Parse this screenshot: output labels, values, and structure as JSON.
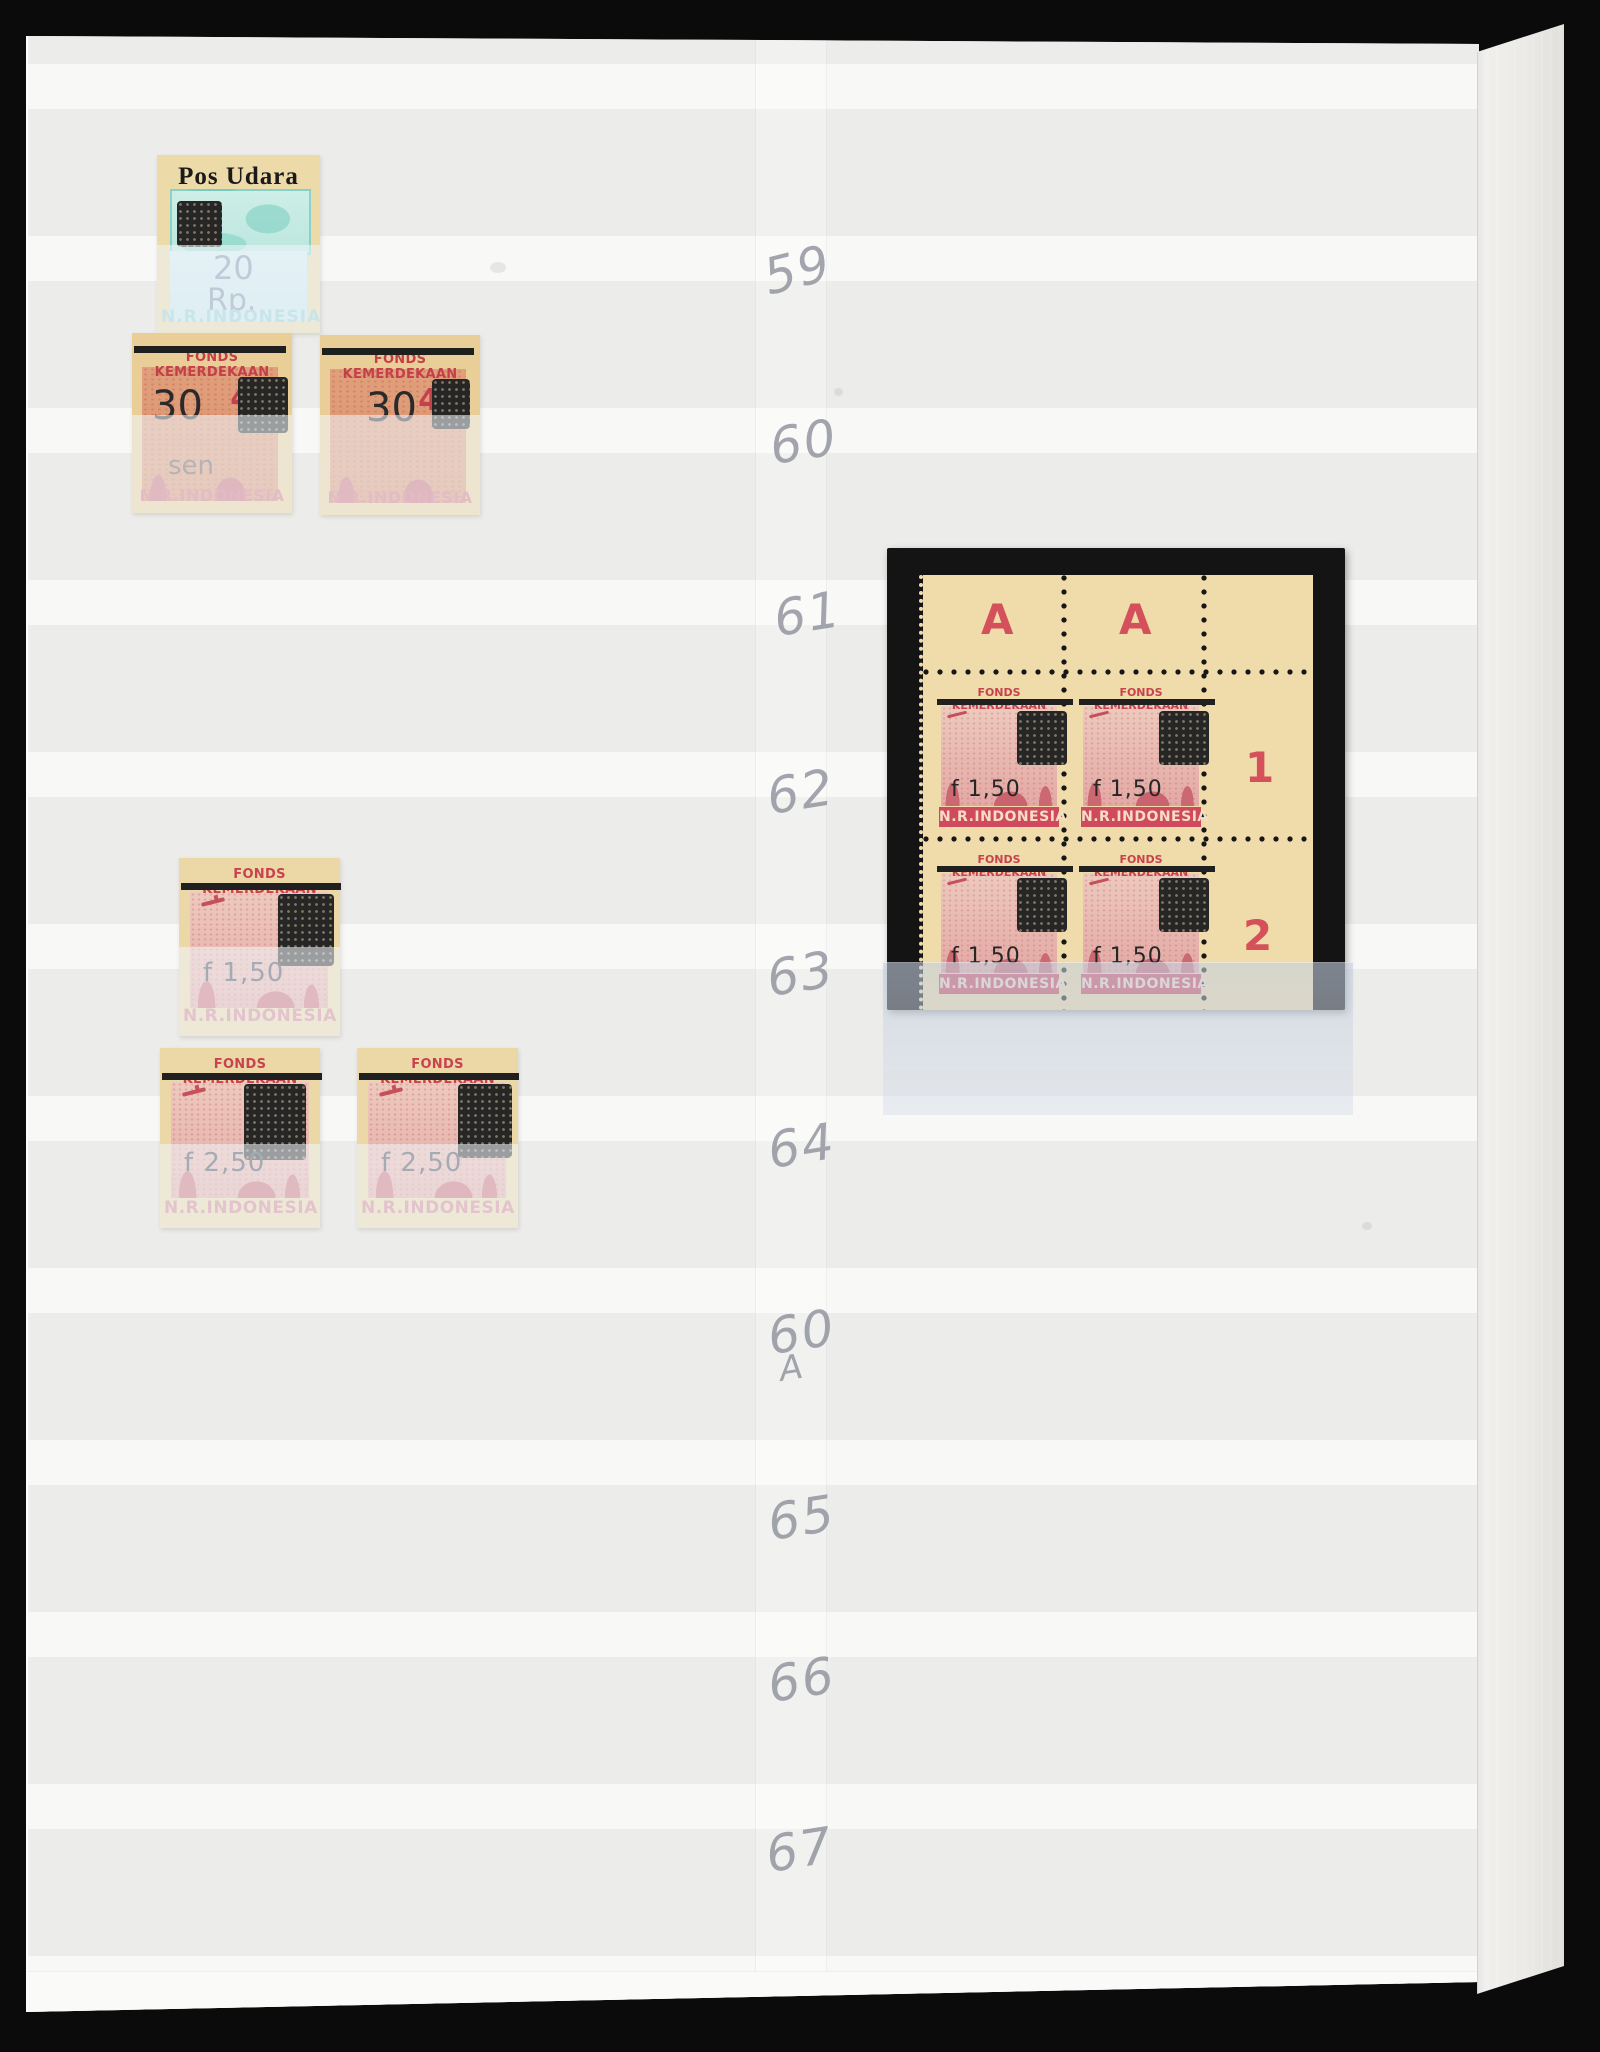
{
  "scene": {
    "description": "Stockbook album page with Indonesian revolutionary-period overprinted stamps and a corner block of four mounted on a black card",
    "colors": {
      "photo_background": "#0b0b0b",
      "page_band_light": "#f8f8f7",
      "page_band_dark": "#ececea",
      "stamp_paper_cream": "#eed9a4",
      "stamp_red": "#cf4a5c",
      "overprint_black": "#202020",
      "plate_marking_red": "#d4505a",
      "pencil_gray": "#9496a0",
      "glassine_blue": "#c5cfdf",
      "block_mount_black": "#141414"
    }
  },
  "pencil": {
    "n59": "59",
    "n60": "60",
    "n61": "61",
    "n62": "62",
    "n63": "63",
    "n64": "64",
    "n60a_main": "60",
    "n60a_suffix": "A",
    "n65": "65",
    "n66": "66",
    "n67": "67"
  },
  "stamps": {
    "fonds_header": "FONDS KEMERDEKAAN",
    "country": "N.R.INDONESIA",
    "pos_udara": {
      "title": "Pos Udara",
      "value": "20",
      "currency": "Rp."
    },
    "surcharge_30": "30",
    "unit_sen": "sen",
    "base_value": "40",
    "surcharge_150": "f 1,50",
    "surcharge_250": "f 2,50",
    "block": {
      "plate_letter_1": "A",
      "plate_letter_2": "A",
      "plate_number_1": "1",
      "plate_number_2": "2"
    }
  }
}
